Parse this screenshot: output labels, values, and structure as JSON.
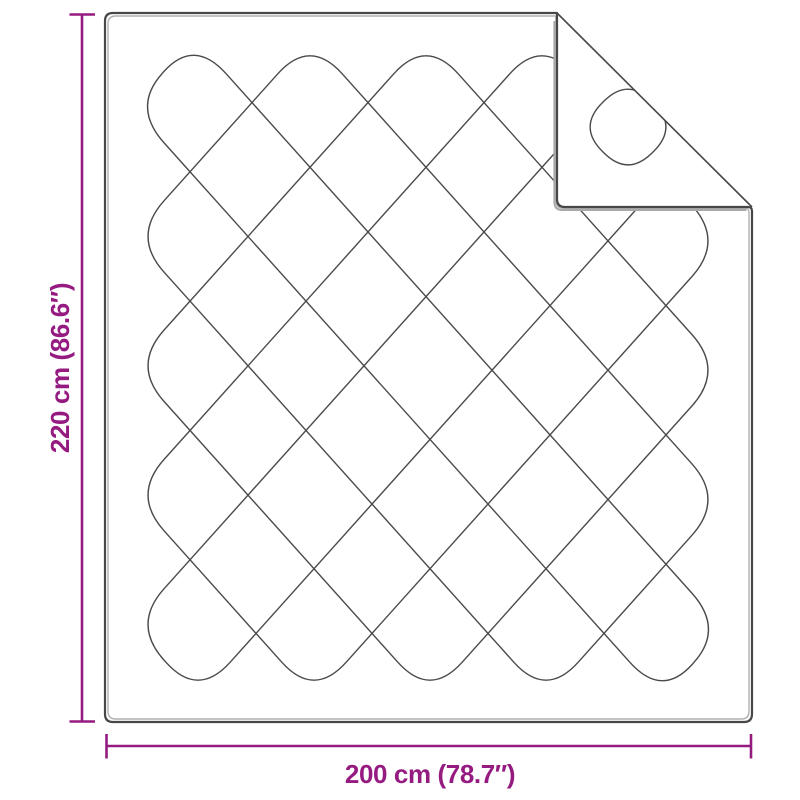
{
  "diagram": {
    "height_label": "220 cm (86.6″)",
    "width_label": "200 cm (78.7″)",
    "accent_color": "#951B81",
    "outline_color": "#474747",
    "pattern_line_color": "#4A4A4A",
    "shadow_color": "#A9A9A9",
    "inner_edge_color": "#B0B0B0",
    "background_color": "#FFFFFF"
  }
}
